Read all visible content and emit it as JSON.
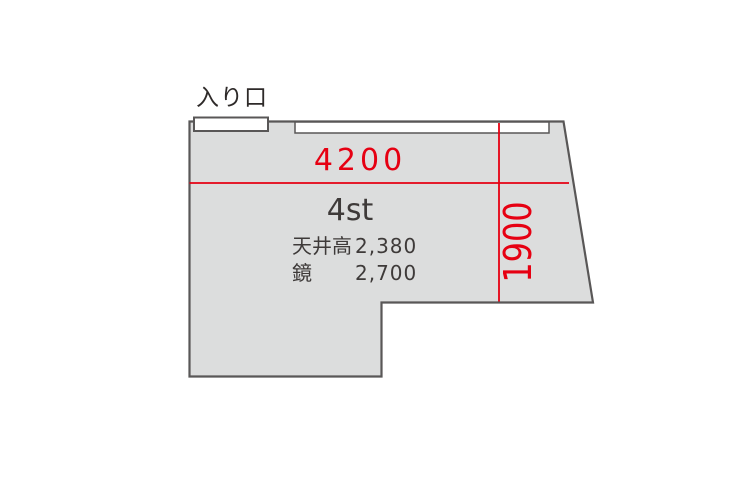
{
  "floorplan": {
    "entrance_label": "入り口",
    "room_name": "4st",
    "width_dimension": "4200",
    "depth_dimension": "1900",
    "specs": [
      {
        "label": "天井高",
        "value": "2,380"
      },
      {
        "label": "鏡",
        "value": "2,700"
      }
    ],
    "colors": {
      "dimension_red": "#e60012",
      "room_fill": "#dcdddd",
      "wall_stroke": "#595757",
      "text_dark": "#3e3a39"
    }
  }
}
